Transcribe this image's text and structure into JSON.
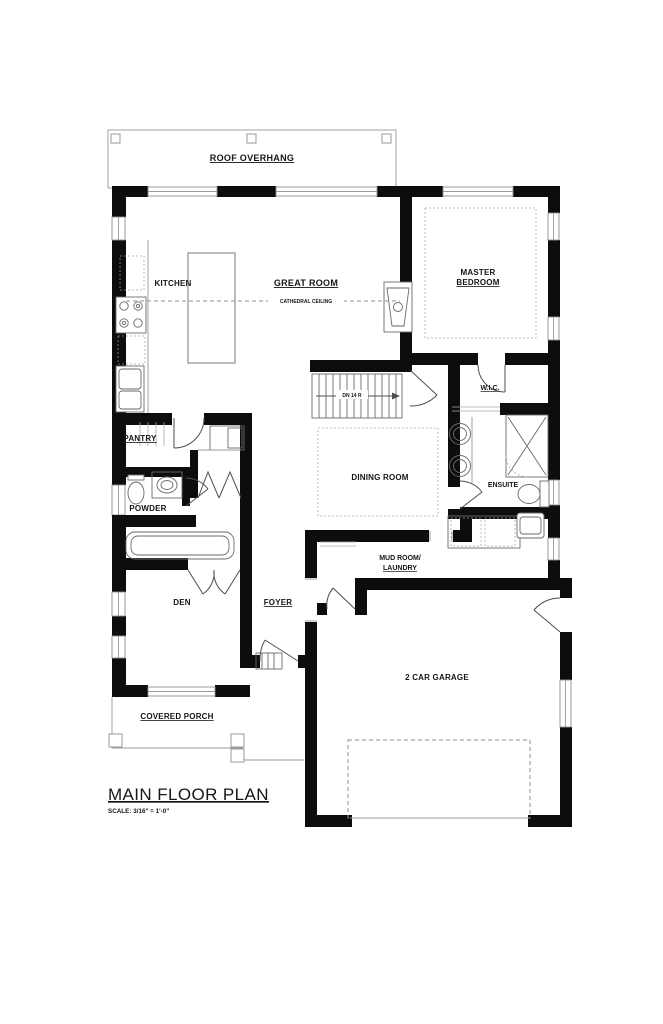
{
  "plan": {
    "title": "MAIN FLOOR PLAN",
    "scale_note": "SCALE: 3/16\" = 1'-0\"",
    "rooms": {
      "kitchen": "KITCHEN",
      "great_room": "GREAT ROOM",
      "master_line1": "MASTER",
      "master_line2": "BEDROOM",
      "wic": "W.I.C.",
      "pantry": "PANTRY",
      "dining": "DINING ROOM",
      "ensuite": "ENSUITE",
      "powder": "POWDER",
      "den": "DEN",
      "foyer": "FOYER",
      "mud_line1": "MUD ROOM/",
      "mud_line2": "LAUNDRY",
      "garage": "2 CAR GARAGE",
      "porch": "COVERED PORCH"
    },
    "annotations": {
      "roof_overhang": "ROOF OVERHANG",
      "cathedral_ceiling": "CATHEDRAL CEILING",
      "stair_note": "DN 14 R",
      "sink_label": "SINK"
    },
    "colors": {
      "wall": "#0d0d0d",
      "thin_line": "#8f8f8f",
      "ink": "#161616",
      "background": "#ffffff"
    }
  }
}
